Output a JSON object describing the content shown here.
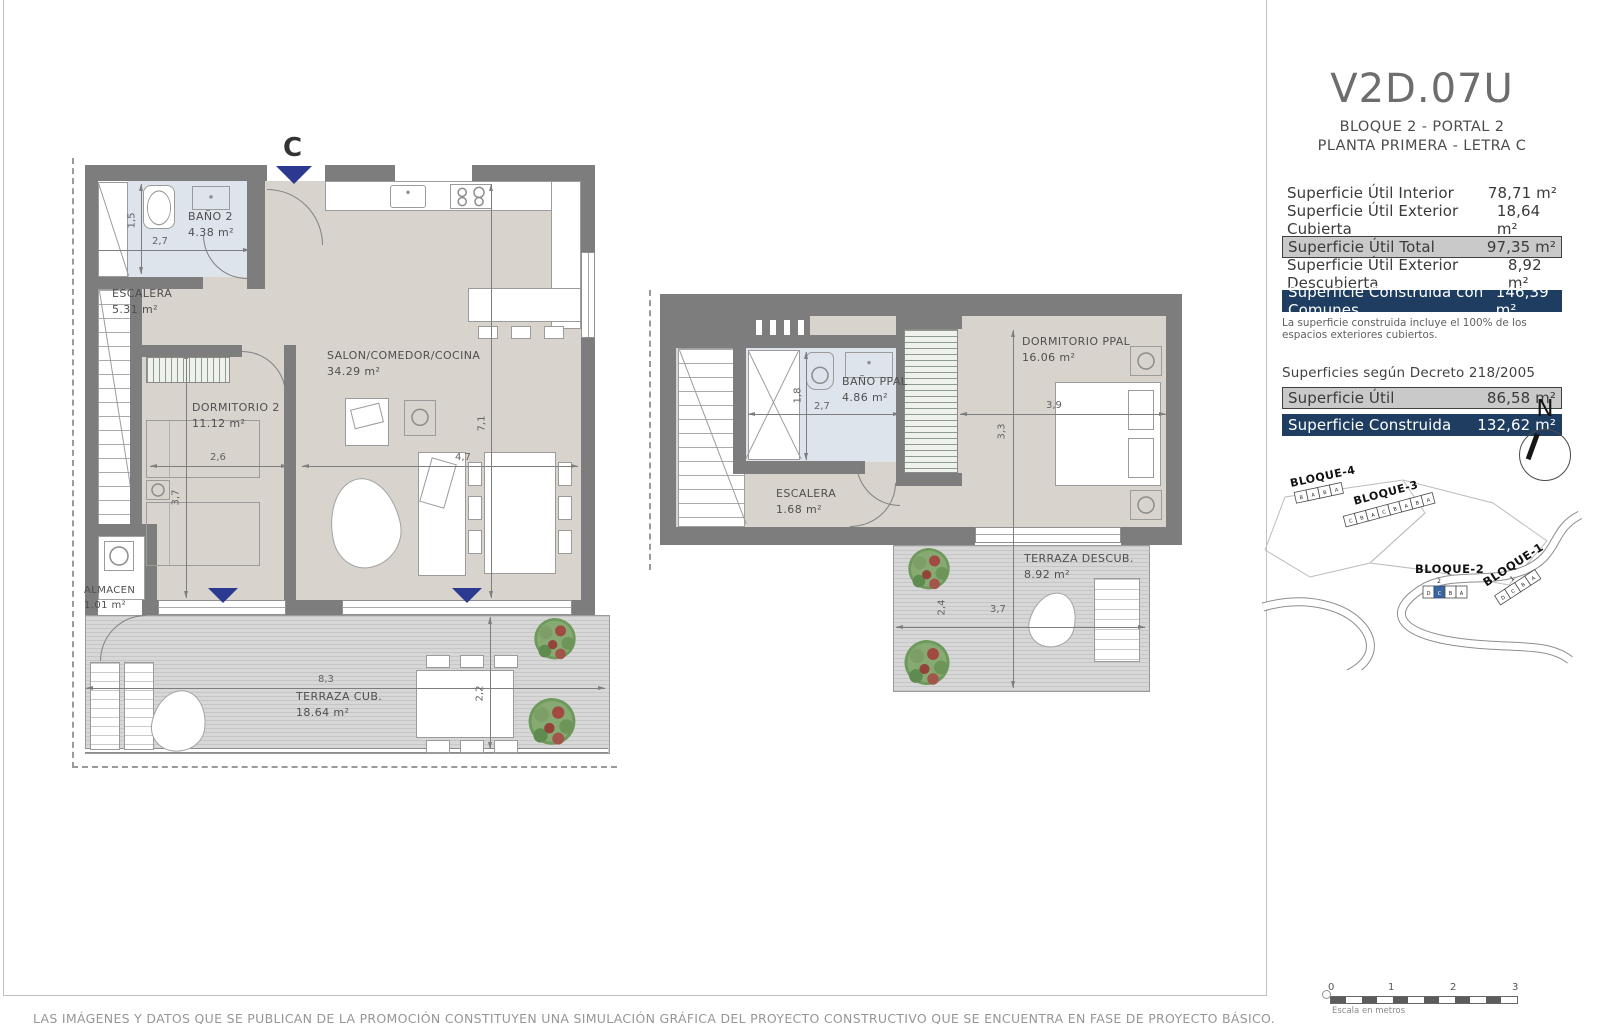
{
  "colors": {
    "navy": "#1e3d61",
    "row_gray": "#c9c9c9",
    "wall": "#7d7d7d",
    "marker_navy": "#2b3990",
    "unit_blue": "#3a66a0",
    "floor_beige": "#d8d3cd",
    "bath_blue": "#dde4ec"
  },
  "title_block": {
    "code": "V2D.07U",
    "line1": "BLOQUE 2 - PORTAL 2",
    "line2": "PLANTA PRIMERA - LETRA C"
  },
  "surfaces": {
    "rows": [
      {
        "label": "Superficie Útil Interior",
        "value": "78,71 m²"
      },
      {
        "label": "Superficie Útil Exterior Cubierta",
        "value": "18,64 m²"
      },
      {
        "label": "Superficie Útil Total",
        "value": "97,35 m²"
      },
      {
        "label": "Superficie Útil Exterior Descubierta",
        "value": "8,92 m²"
      },
      {
        "label": "Superficie Construida con Comunes",
        "value": "146,39 m²"
      }
    ],
    "note": "La superficie construida incluye el 100% de los espacios exteriores cubiertos."
  },
  "decree": {
    "heading": "Superficies según Decreto 218/2005",
    "rows": [
      {
        "label": "Superficie Útil",
        "value": "86,58 m²"
      },
      {
        "label": "Superficie Construida",
        "value": "132,62 m²"
      }
    ]
  },
  "compass": {
    "north": "N"
  },
  "site_plan": {
    "b4": {
      "label": "BLOQUE-4",
      "units": [
        "B",
        "A",
        "B",
        "A"
      ]
    },
    "b3": {
      "label": "BLOQUE-3",
      "units": [
        "C",
        "B",
        "A",
        "C",
        "B",
        "A",
        "B",
        "A"
      ]
    },
    "b2": {
      "label": "BLOQUE-2",
      "portal": "2",
      "units": [
        "D",
        "C",
        "B",
        "A"
      ]
    },
    "b1": {
      "label": "BLOQUE-1",
      "portal": "1",
      "units": [
        "D",
        "C",
        "B",
        "A"
      ]
    }
  },
  "scale_bar": {
    "ticks": [
      "0",
      "1",
      "2",
      "3"
    ],
    "caption": "Escala en metros"
  },
  "plan_lower": {
    "entrance_label": "C",
    "rooms": {
      "bano2": {
        "name": "BAÑO 2",
        "area": "4.38 m²"
      },
      "escalera": {
        "name": "ESCALERA",
        "area": "5.31 m²"
      },
      "dormitorio2": {
        "name": "DORMITORIO 2",
        "area": "11.12 m²"
      },
      "salon": {
        "name": "SALON/COMEDOR/COCINA",
        "area": "34.29 m²"
      },
      "almacen": {
        "name": "ALMACEN",
        "area": "1.01 m²"
      },
      "terraza": {
        "name": "TERRAZA CUB.",
        "area": "18.64 m²"
      }
    },
    "dims": {
      "bano_w": "2,7",
      "bano_h": "1,5",
      "dorm_w": "2,6",
      "dorm_h": "3,7",
      "salon_w": "4,7",
      "salon_h": "7,1",
      "terraza_w": "8,3",
      "terraza_h": "2,2"
    }
  },
  "plan_upper": {
    "rooms": {
      "bano": {
        "name": "BAÑO PPAL",
        "area": "4.86 m²"
      },
      "escalera": {
        "name": "ESCALERA",
        "area": "1.68 m²"
      },
      "dormitorio": {
        "name": "DORMITORIO PPAL",
        "area": "16.06 m²"
      },
      "terraza": {
        "name": "TERRAZA DESCUB.",
        "area": "8.92 m²"
      }
    },
    "dims": {
      "bano_h": "1,8",
      "bano_w": "2,7",
      "dorm_w": "3,9",
      "dorm_h": "3,3",
      "terraza_h": "2,4",
      "terraza_w": "3,7"
    }
  },
  "footer": {
    "disclaimer": "LAS IMÁGENES Y DATOS QUE SE PUBLICAN DE LA PROMOCIÓN CONSTITUYEN UNA SIMULACIÓN GRÁFICA DEL PROYECTO CONSTRUCTIVO QUE SE ENCUENTRA EN FASE DE PROYECTO BÁSICO."
  }
}
